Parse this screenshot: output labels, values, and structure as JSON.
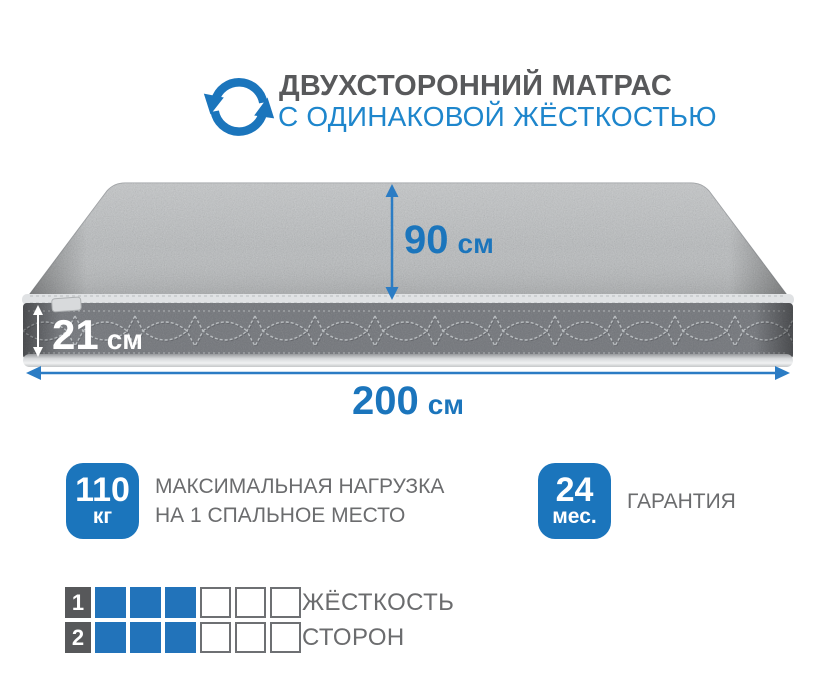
{
  "header": {
    "line1": "ДВУХСТОРОННИЙ МАТРАС",
    "line2": "С ОДИНАКОВОЙ ЖЁСТКОСТЬЮ",
    "icon": "rotate-arrows-icon"
  },
  "dimensions": {
    "depth": {
      "value": "90",
      "unit": "см"
    },
    "height": {
      "value": "21",
      "unit": "см"
    },
    "width": {
      "value": "200",
      "unit": "см"
    }
  },
  "features": [
    {
      "badge_value": "110",
      "badge_unit": "кг",
      "label_line1": "МАКСИМАЛЬНАЯ НАГРУЗКА",
      "label_line2": "НА 1 СПАЛЬНОЕ МЕСТО"
    },
    {
      "badge_value": "24",
      "badge_unit": "мес.",
      "label_line1": "ГАРАНТИЯ",
      "label_line2": ""
    }
  ],
  "firmness": {
    "rows": [
      {
        "number": "1",
        "filled": 3,
        "total": 6
      },
      {
        "number": "2",
        "filled": 3,
        "total": 6
      }
    ],
    "label_line1": "ЖЁСТКОСТЬ",
    "label_line2": "СТОРОН"
  },
  "colors": {
    "accent": "#1b75bc",
    "header_blue": "#1e86cc",
    "title_gray": "#58595b",
    "label_gray": "#6b6c6e",
    "arrow_blue": "#2b7cc4",
    "grid_blue": "#2273ba",
    "number_bg": "#57585a"
  }
}
